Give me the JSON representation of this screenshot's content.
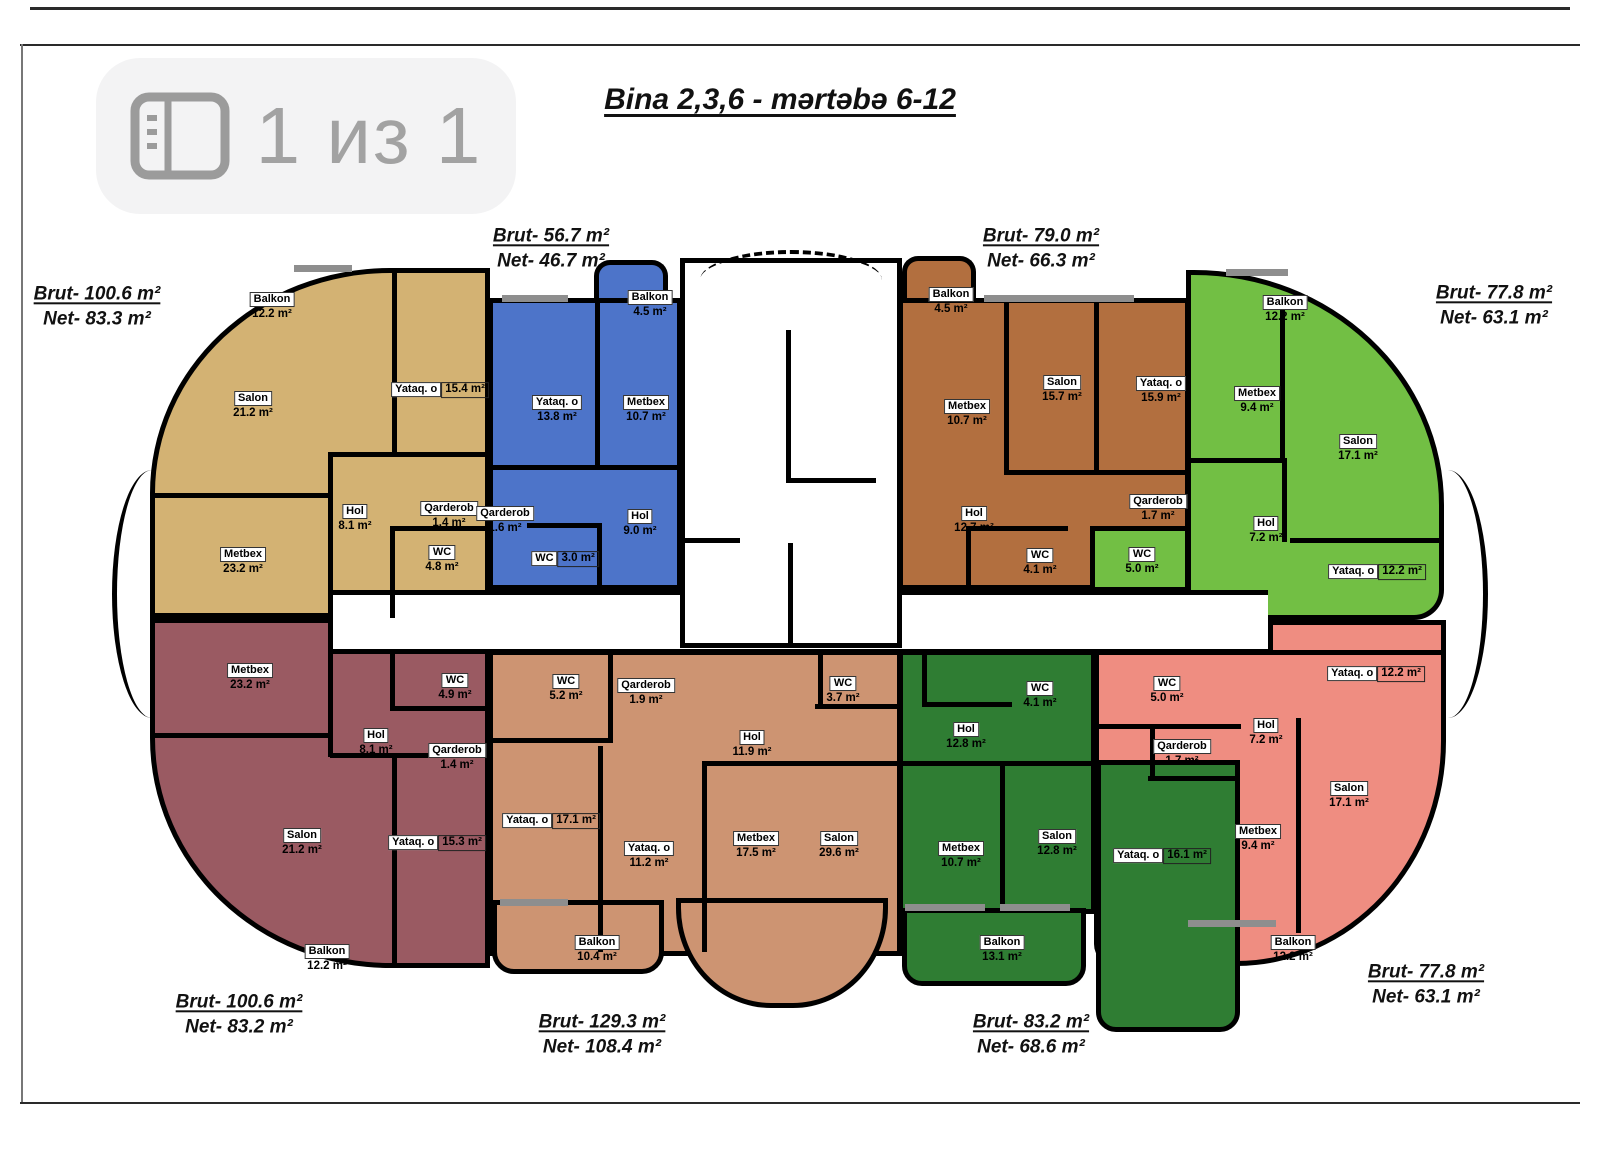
{
  "viewer": {
    "page_indicator": "1 из 1"
  },
  "header": {
    "title": "Bina 2,3,6 - mərtəbə 6-12"
  },
  "colors": {
    "walls": "#000000",
    "window_sill": "#8e8e8e",
    "indicator_bg": "#f3f3f4",
    "indicator_fg": "#a2a2a2"
  },
  "apartments": [
    {
      "name": "top-left",
      "color": "#d3b273",
      "brut": "Brut- 100.6 m²",
      "net": "Net- 83.3 m²",
      "rooms": [
        {
          "n": "Balkon",
          "a": "12.2 m²"
        },
        {
          "n": "Salon",
          "a": "21.2 m²"
        },
        {
          "n": "Yataq. o",
          "a": "15.4 m²"
        },
        {
          "n": "Hol",
          "a": "8.1 m²"
        },
        {
          "n": "Qarderob",
          "a": "1.4 m²"
        },
        {
          "n": "WC",
          "a": "4.8 m²"
        },
        {
          "n": "Metbex",
          "a": "23.2 m²"
        }
      ]
    },
    {
      "name": "top-mid-left",
      "color": "#4d74c9",
      "brut": "Brut- 56.7 m²",
      "net": "Net- 46.7 m²",
      "rooms": [
        {
          "n": "Balkon",
          "a": "4.5 m²"
        },
        {
          "n": "Yataq. o",
          "a": "13.8 m²"
        },
        {
          "n": "Metbex",
          "a": "10.7 m²"
        },
        {
          "n": "Qarderob",
          "a": "1.6 m²"
        },
        {
          "n": "WC",
          "a": "3.0 m²"
        },
        {
          "n": "Hol",
          "a": "9.0 m²"
        }
      ]
    },
    {
      "name": "top-mid-right",
      "color": "#b26f3f",
      "brut": "Brut- 79.0 m²",
      "net": "Net- 66.3 m²",
      "rooms": [
        {
          "n": "Balkon",
          "a": "4.5 m²"
        },
        {
          "n": "Metbex",
          "a": "10.7 m²"
        },
        {
          "n": "Salon",
          "a": "15.7 m²"
        },
        {
          "n": "Yataq. o",
          "a": "15.9 m²"
        },
        {
          "n": "Hol",
          "a": "12.7 m²"
        },
        {
          "n": "Qarderob",
          "a": "1.7 m²"
        },
        {
          "n": "WC",
          "a": "4.1 m²"
        }
      ]
    },
    {
      "name": "top-right",
      "color": "#72bf44",
      "brut": "Brut- 77.8 m²",
      "net": "Net- 63.1 m²",
      "rooms": [
        {
          "n": "Balkon",
          "a": "12.2 m²"
        },
        {
          "n": "Metbex",
          "a": "9.4 m²"
        },
        {
          "n": "Salon",
          "a": "17.1 m²"
        },
        {
          "n": "Hol",
          "a": "7.2 m²"
        },
        {
          "n": "WC",
          "a": "5.0 m²"
        },
        {
          "n": "Yataq. o",
          "a": "12.2 m²"
        }
      ]
    },
    {
      "name": "bottom-left",
      "color": "#9a5a62",
      "brut": "Brut- 100.6 m²",
      "net": "Net- 83.2 m²",
      "rooms": [
        {
          "n": "Metbex",
          "a": "23.2 m²"
        },
        {
          "n": "WC",
          "a": "4.9 m²"
        },
        {
          "n": "Hol",
          "a": "8.1 m²"
        },
        {
          "n": "Qarderob",
          "a": "1.4 m²"
        },
        {
          "n": "Salon",
          "a": "21.2 m²"
        },
        {
          "n": "Yataq. o",
          "a": "15.3 m²"
        },
        {
          "n": "Balkon",
          "a": "12.2 m²"
        }
      ]
    },
    {
      "name": "bottom-mid-left",
      "color": "#cd9472",
      "brut": "Brut- 129.3 m²",
      "net": "Net- 108.4 m²",
      "rooms": [
        {
          "n": "WC",
          "a": "5.2 m²"
        },
        {
          "n": "Qarderob",
          "a": "1.9 m²"
        },
        {
          "n": "Yataq. o",
          "a": "17.1 m²"
        },
        {
          "n": "Yataq. o",
          "a": "11.2 m²"
        },
        {
          "n": "Hol",
          "a": "11.9 m²"
        },
        {
          "n": "WC",
          "a": "3.7 m²"
        },
        {
          "n": "Metbex",
          "a": "17.5 m²"
        },
        {
          "n": "Salon",
          "a": "29.6 m²"
        },
        {
          "n": "Balkon",
          "a": "10.4 m²"
        }
      ]
    },
    {
      "name": "bottom-mid-right",
      "color": "#2f7d33",
      "brut": "Brut- 83.2 m²",
      "net": "Net- 68.6 m²",
      "rooms": [
        {
          "n": "WC",
          "a": "4.1 m²"
        },
        {
          "n": "Hol",
          "a": "12.8 m²"
        },
        {
          "n": "Metbex",
          "a": "10.7 m²"
        },
        {
          "n": "Salon",
          "a": "12.8 m²"
        },
        {
          "n": "Yataq. o",
          "a": "16.1 m²"
        },
        {
          "n": "Balkon",
          "a": "13.1 m²"
        }
      ]
    },
    {
      "name": "bottom-right",
      "color": "#ef8d81",
      "brut": "Brut- 77.8 m²",
      "net": "Net- 63.1 m²",
      "rooms": [
        {
          "n": "WC",
          "a": "5.0 m²"
        },
        {
          "n": "Qarderob",
          "a": "1.7 m²"
        },
        {
          "n": "Yataq. o",
          "a": "12.2 m²"
        },
        {
          "n": "Hol",
          "a": "7.2 m²"
        },
        {
          "n": "Salon",
          "a": "17.1 m²"
        },
        {
          "n": "Metbex",
          "a": "9.4 m²"
        },
        {
          "n": "Balkon",
          "a": "12.2 m²"
        }
      ]
    }
  ]
}
